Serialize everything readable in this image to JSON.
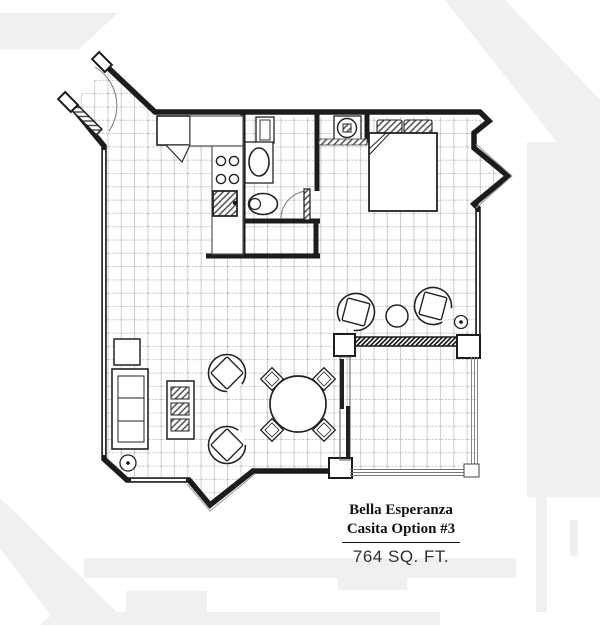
{
  "title_block": {
    "line1": "Bella Esperanza",
    "line2": "Casita Option #3",
    "area": "764 SQ. FT."
  },
  "colors": {
    "walls": "#1c1c1c",
    "tile_grid_vertical": "#c3c3c3",
    "tile_grid_horizontal": "#b5b5b5",
    "watermark": "#f0f0f0",
    "background": "#ffffff",
    "text": "#111111"
  },
  "symbols": [
    "entry-door",
    "door-swing-arc",
    "kitchen-counter",
    "refrigerator",
    "stove-burners",
    "kitchen-sink",
    "bathroom-vanity",
    "bathroom-mirror",
    "toilet",
    "bathroom-door",
    "water-heater",
    "bed",
    "pillows",
    "armchair",
    "side-table",
    "sofa",
    "end-table",
    "shelf-unit",
    "dining-table",
    "dining-chair",
    "plant",
    "patio",
    "sliding-glass-door",
    "screen-wall",
    "bay-window",
    "tile-floor",
    "watermark-shapes"
  ]
}
